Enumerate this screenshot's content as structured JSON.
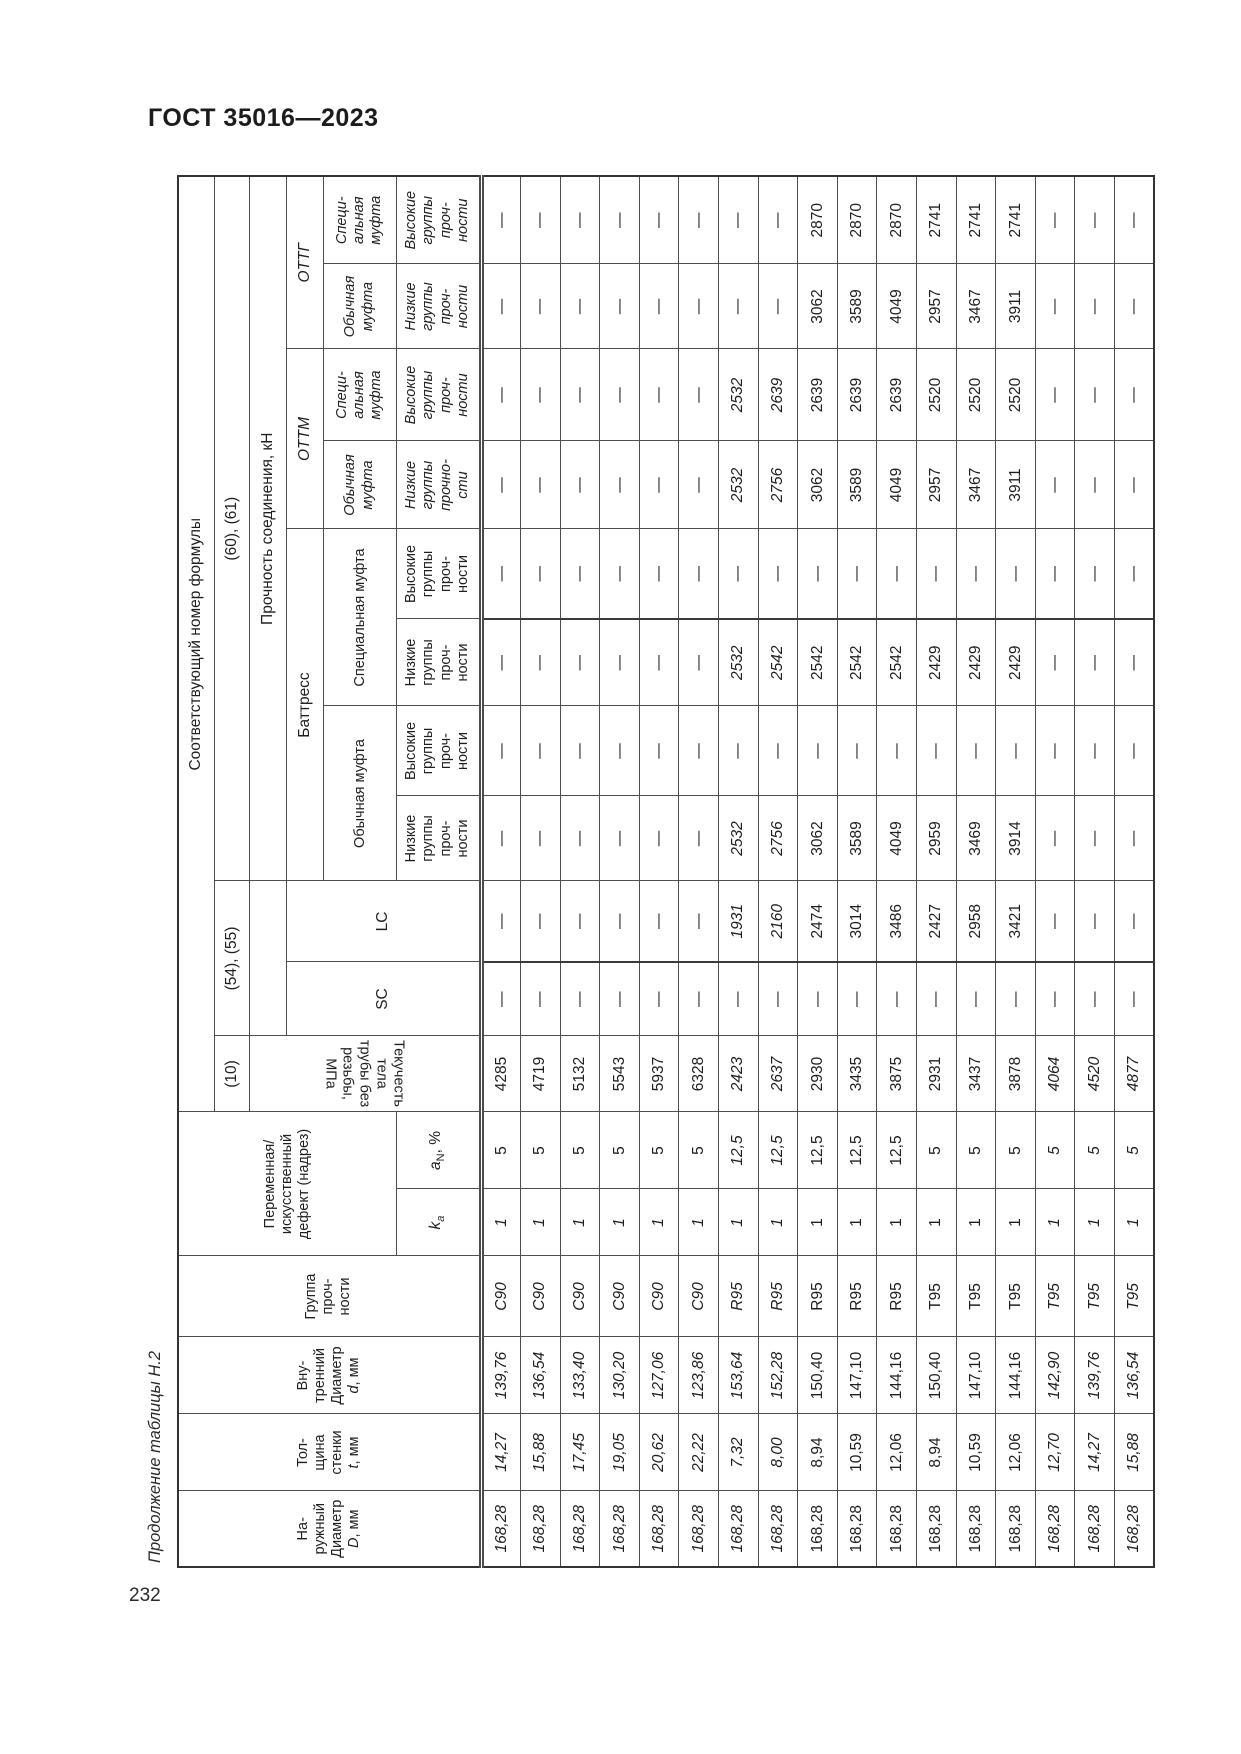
{
  "page": {
    "header_title": "ГОСТ 35016—2023",
    "table_caption": "Продолжение таблицы Н.2",
    "page_number": "232"
  },
  "colors": {
    "page_bg": "#ffffff",
    "text": "#222222",
    "border": "#4d4d4d"
  },
  "header": {
    "col_outer": {
      "label": "На-\nружный\nДиаметр",
      "sym": "D",
      "unit": ", мм"
    },
    "col_wall": {
      "label": "Тол-\nщина\nстенки",
      "sym": "t",
      "unit": ", мм"
    },
    "col_inner": {
      "label": "Вну-\nтренний\nДиаметр",
      "sym": "d",
      "unit": ", мм"
    },
    "col_grade": "Группа\nпроч-\nности",
    "defect": "Переменная/\nискусственный\nдефект (надрез)",
    "ka_sym": "k",
    "ka_sub": "а",
    "an_sym": "a",
    "an_sub": "N",
    "an_unit": ", %",
    "formula_title": "Соответствующий номер формулы",
    "f_yield": "(10)",
    "f_sclc": "(54), (55)",
    "f_conn": "(60), (61)",
    "yield": "Текучесть тела трубы без\nрезьбы, МПа",
    "sc": "SC",
    "lc": "LC",
    "strength": "Прочность соединения, кН",
    "battress": "Баттресс",
    "ottm": "ОТТМ",
    "ottg": "ОТТГ",
    "batt_usual": "Обычная муфта",
    "batt_special": "Специальная муфта",
    "usual2": "Обычная\nмуфта",
    "special3": "Специ-\nальная\nмуфта",
    "low4": "Низкие\nгруппы\nпроч-\nности",
    "high4": "Высокие\nгруппы\nпроч-\nности",
    "low_ottm": "Низкие\nгруппы\nпрочно-\nсти"
  },
  "table": {
    "columns": [
      "outer-diameter-D",
      "wall-thickness-t",
      "inner-diameter-d",
      "strength-grade",
      "ka",
      "aN",
      "body-yield-MPa",
      "SC",
      "LC",
      "battress-usual-low",
      "battress-usual-high",
      "battress-special-low",
      "battress-special-high",
      "ottm-usual-low",
      "ottm-special-high",
      "ottg-usual-low",
      "ottg-special-high"
    ],
    "rows": [
      [
        "168,28",
        "14,27",
        "139,76",
        "С90",
        "1",
        "5",
        "4285",
        "—",
        "—",
        "—",
        "—",
        "—",
        "—",
        "—",
        "—",
        "—",
        "—"
      ],
      [
        "168,28",
        "15,88",
        "136,54",
        "С90",
        "1",
        "5",
        "4719",
        "—",
        "—",
        "—",
        "—",
        "—",
        "—",
        "—",
        "—",
        "—",
        "—"
      ],
      [
        "168,28",
        "17,45",
        "133,40",
        "С90",
        "1",
        "5",
        "5132",
        "—",
        "—",
        "—",
        "—",
        "—",
        "—",
        "—",
        "—",
        "—",
        "—"
      ],
      [
        "168,28",
        "19,05",
        "130,20",
        "С90",
        "1",
        "5",
        "5543",
        "—",
        "—",
        "—",
        "—",
        "—",
        "—",
        "—",
        "—",
        "—",
        "—"
      ],
      [
        "168,28",
        "20,62",
        "127,06",
        "С90",
        "1",
        "5",
        "5937",
        "—",
        "—",
        "—",
        "—",
        "—",
        "—",
        "—",
        "—",
        "—",
        "—"
      ],
      [
        "168,28",
        "22,22",
        "123,86",
        "С90",
        "1",
        "5",
        "6328",
        "—",
        "—",
        "—",
        "—",
        "—",
        "—",
        "—",
        "—",
        "—",
        "—"
      ],
      [
        "168,28",
        "7,32",
        "153,64",
        "R95",
        "1",
        "12,5",
        "2423",
        "—",
        "1931",
        "2532",
        "—",
        "2532",
        "—",
        "2532",
        "2532",
        "—",
        "—"
      ],
      [
        "168,28",
        "8,00",
        "152,28",
        "R95",
        "1",
        "12,5",
        "2637",
        "—",
        "2160",
        "2756",
        "—",
        "2542",
        "—",
        "2756",
        "2639",
        "—",
        "—"
      ],
      [
        "168,28",
        "8,94",
        "150,40",
        "R95",
        "1",
        "12,5",
        "2930",
        "—",
        "2474",
        "3062",
        "—",
        "2542",
        "—",
        "3062",
        "2639",
        "3062",
        "2870"
      ],
      [
        "168,28",
        "10,59",
        "147,10",
        "R95",
        "1",
        "12,5",
        "3435",
        "—",
        "3014",
        "3589",
        "—",
        "2542",
        "—",
        "3589",
        "2639",
        "3589",
        "2870"
      ],
      [
        "168,28",
        "12,06",
        "144,16",
        "R95",
        "1",
        "12,5",
        "3875",
        "—",
        "3486",
        "4049",
        "—",
        "2542",
        "—",
        "4049",
        "2639",
        "4049",
        "2870"
      ],
      [
        "168,28",
        "8,94",
        "150,40",
        "T95",
        "1",
        "5",
        "2931",
        "—",
        "2427",
        "2959",
        "—",
        "2429",
        "—",
        "2957",
        "2520",
        "2957",
        "2741"
      ],
      [
        "168,28",
        "10,59",
        "147,10",
        "T95",
        "1",
        "5",
        "3437",
        "—",
        "2958",
        "3469",
        "—",
        "2429",
        "—",
        "3467",
        "2520",
        "3467",
        "2741"
      ],
      [
        "168,28",
        "12,06",
        "144,16",
        "T95",
        "1",
        "5",
        "3878",
        "—",
        "3421",
        "3914",
        "—",
        "2429",
        "—",
        "3911",
        "2520",
        "3911",
        "2741"
      ],
      [
        "168,28",
        "12,70",
        "142,90",
        "T95",
        "1",
        "5",
        "4064",
        "—",
        "—",
        "—",
        "—",
        "—",
        "—",
        "—",
        "—",
        "—",
        "—"
      ],
      [
        "168,28",
        "14,27",
        "139,76",
        "T95",
        "1",
        "5",
        "4520",
        "—",
        "—",
        "—",
        "—",
        "—",
        "—",
        "—",
        "—",
        "—",
        "—"
      ],
      [
        "168,28",
        "15,88",
        "136,54",
        "T95",
        "1",
        "5",
        "4877",
        "—",
        "—",
        "—",
        "—",
        "—",
        "—",
        "—",
        "—",
        "—",
        "—"
      ]
    ],
    "italics": {
      "full_rows": [
        6,
        7,
        14,
        15,
        16
      ],
      "partial_rows": [
        0,
        1,
        2,
        3,
        4,
        5
      ],
      "partial_cols": [
        0,
        1,
        2,
        3,
        4
      ]
    }
  }
}
